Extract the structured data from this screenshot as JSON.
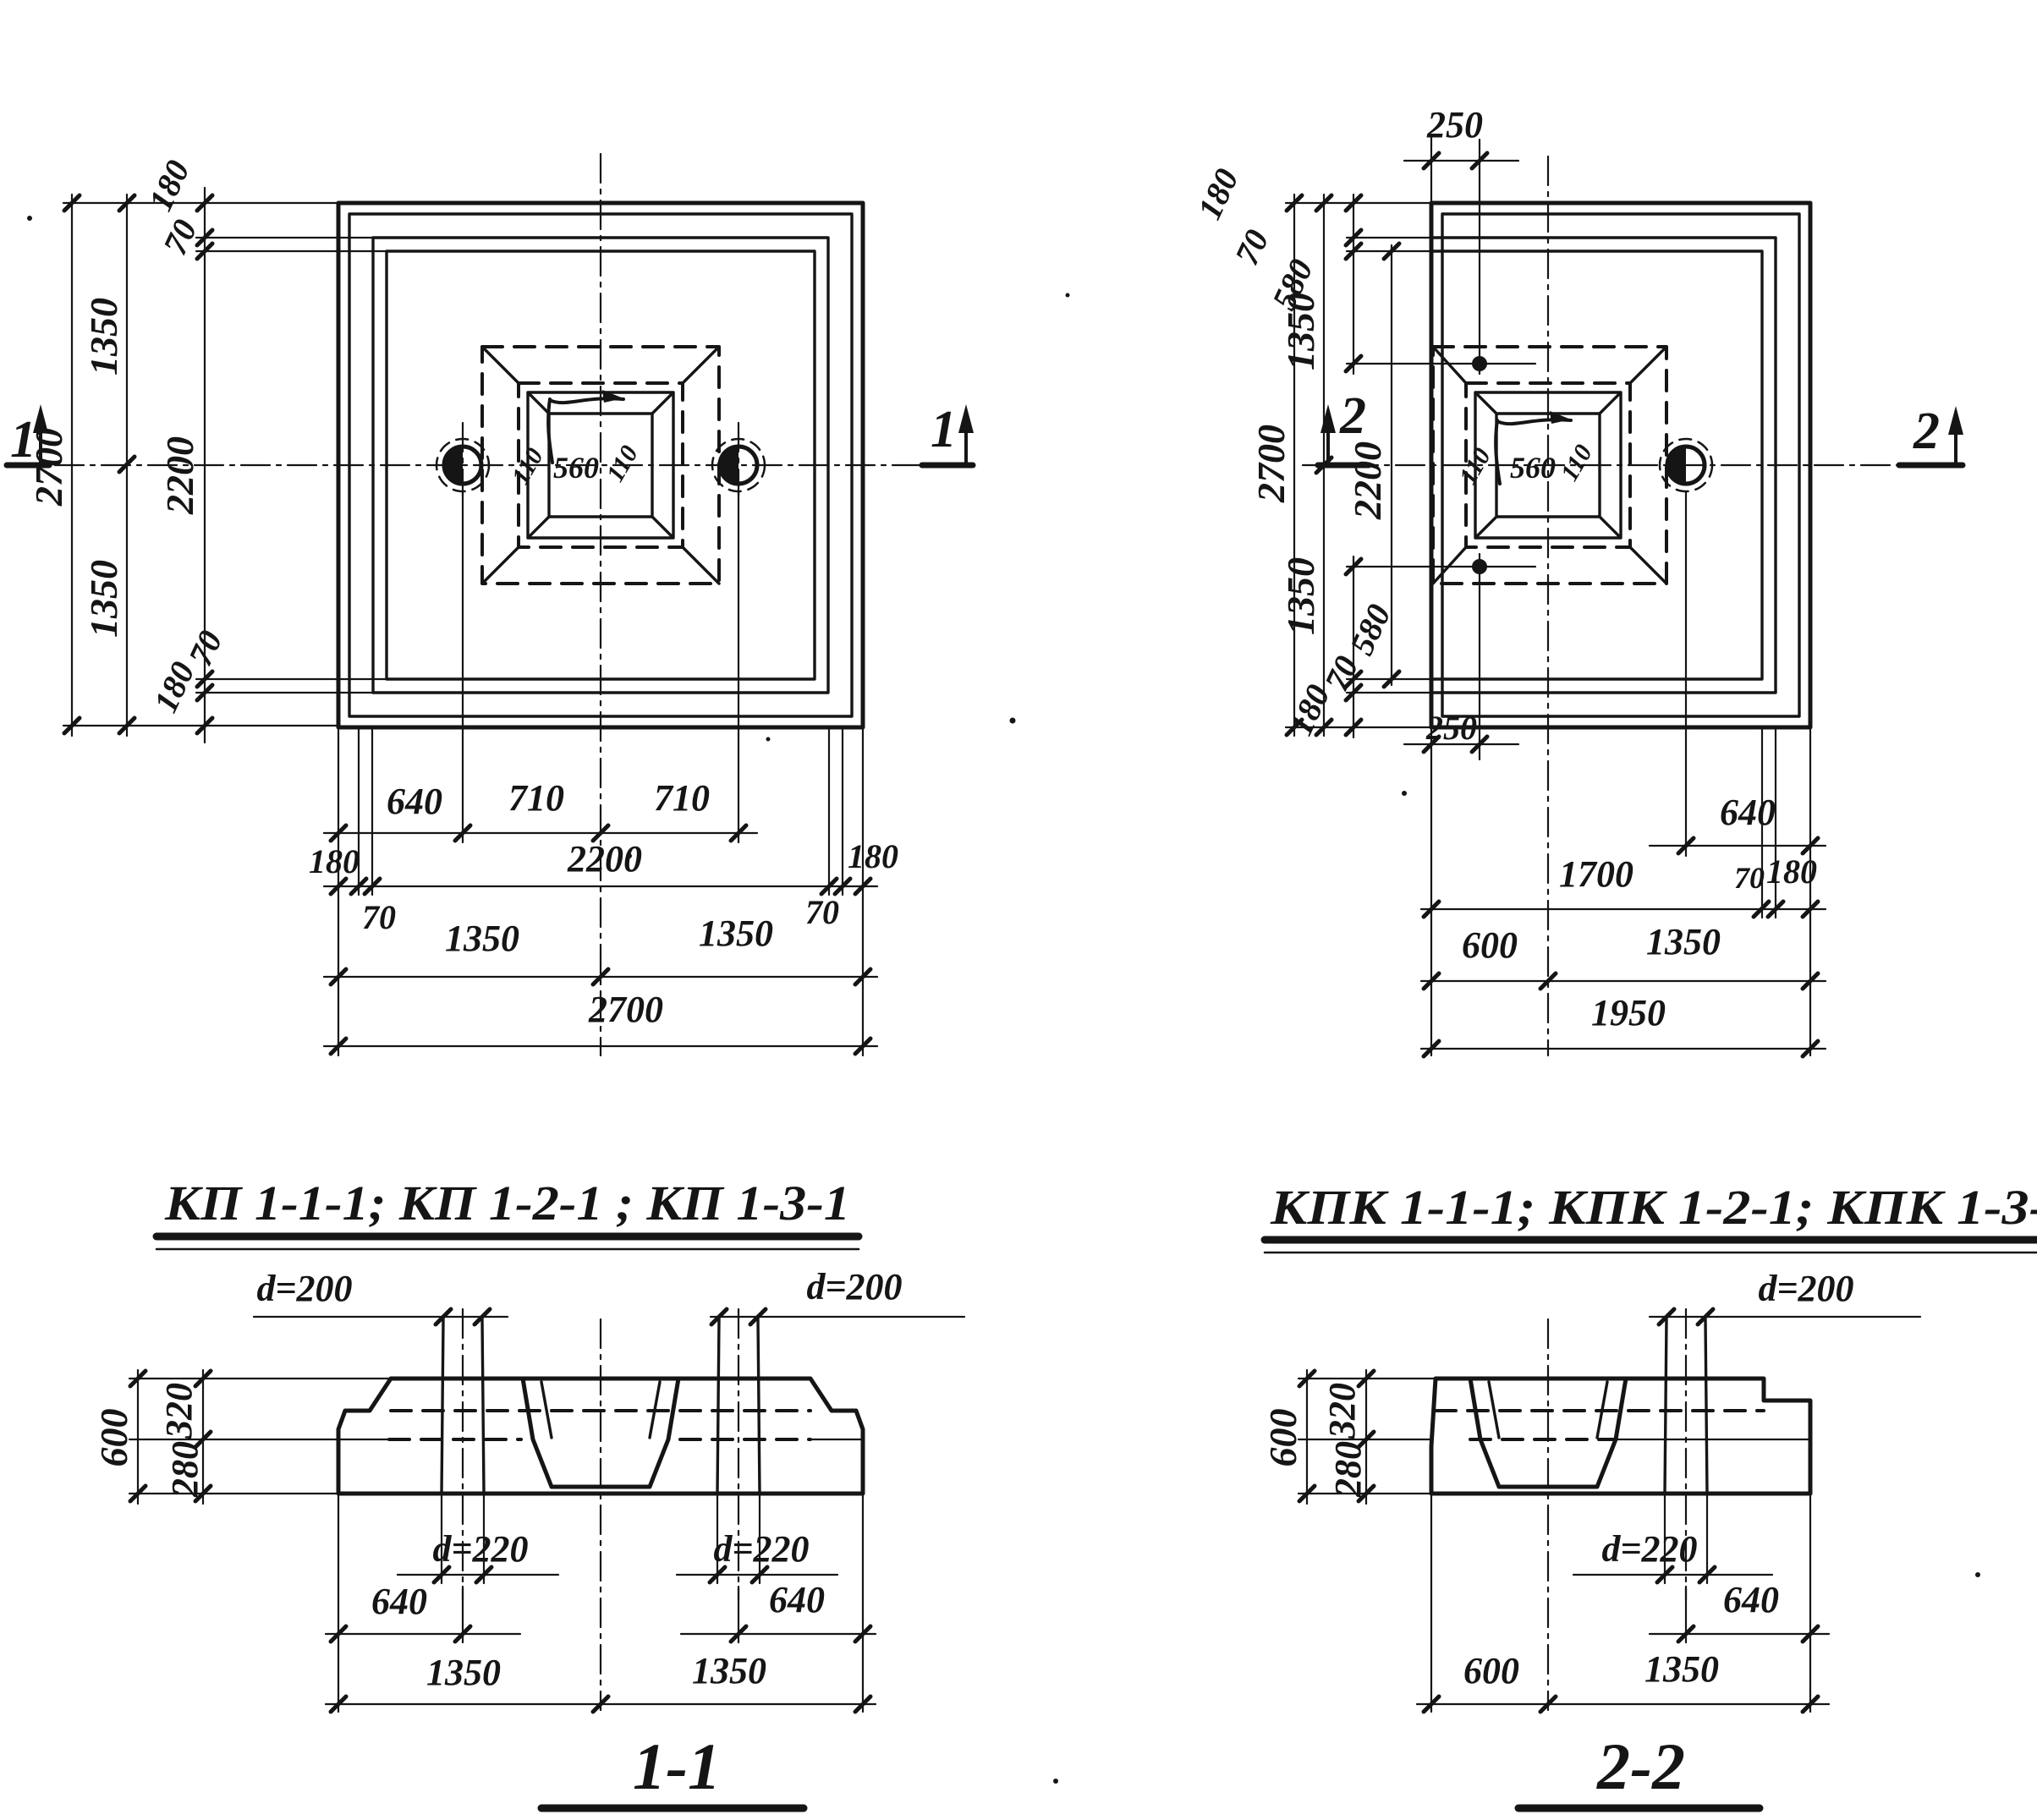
{
  "plan_kp": {
    "title": "КП 1-1-1; КП 1-2-1 ; КП 1-3-1",
    "mark": "1",
    "socket_110_left": "110",
    "socket_560": "560",
    "socket_110_right": "110",
    "col_180_top": "180",
    "col_70_top": "70",
    "col_1350_top": "1350",
    "col_2700": "2700",
    "col_2200": "2200",
    "col_1350_bot": "1350",
    "col_70_bot": "70",
    "col_180_bot": "180",
    "row1_640": "640",
    "row1_710a": "710",
    "row1_710b": "710",
    "row2_180l": "180",
    "row2_2200": "2200",
    "row2_180r": "180",
    "row2_70l": "70",
    "row2_70r": "70",
    "row3_1350l": "1350",
    "row3_1350r": "1350",
    "row4_2700": "2700"
  },
  "plan_kpk": {
    "title": "КПК 1-1-1; КПК 1-2-1; КПК 1-3-1",
    "mark": "2",
    "socket_110_left": "110",
    "socket_560": "560",
    "socket_110_right": "110",
    "top_250": "250",
    "tl_180": "180",
    "tl_70": "70",
    "tl_580": "580",
    "bl_580": "580",
    "bl_70": "70",
    "bl_180": "180",
    "bot_250": "250",
    "col_1350_top": "1350",
    "col_2700": "2700",
    "col_2200": "2200",
    "col_1350_bot": "1350",
    "row1_640": "640",
    "row2_1700": "1700",
    "row2_70": "70",
    "row2_180": "180",
    "row3_600": "600",
    "row3_1350": "1350",
    "row4_1950": "1950"
  },
  "section_1_1": {
    "title": "1-1",
    "d200_l": "d=200",
    "d200_r": "d=200",
    "d220_l": "d=220",
    "d220_r": "d=220",
    "h600": "600",
    "h320": "320",
    "h280": "280",
    "b640_l": "640",
    "b640_r": "640",
    "b1350_l": "1350",
    "b1350_r": "1350"
  },
  "section_2_2": {
    "title": "2-2",
    "d200": "d=200",
    "d220": "d=220",
    "h600": "600",
    "h320": "320",
    "h280": "280",
    "b640": "640",
    "b600": "600",
    "b1350": "1350"
  }
}
